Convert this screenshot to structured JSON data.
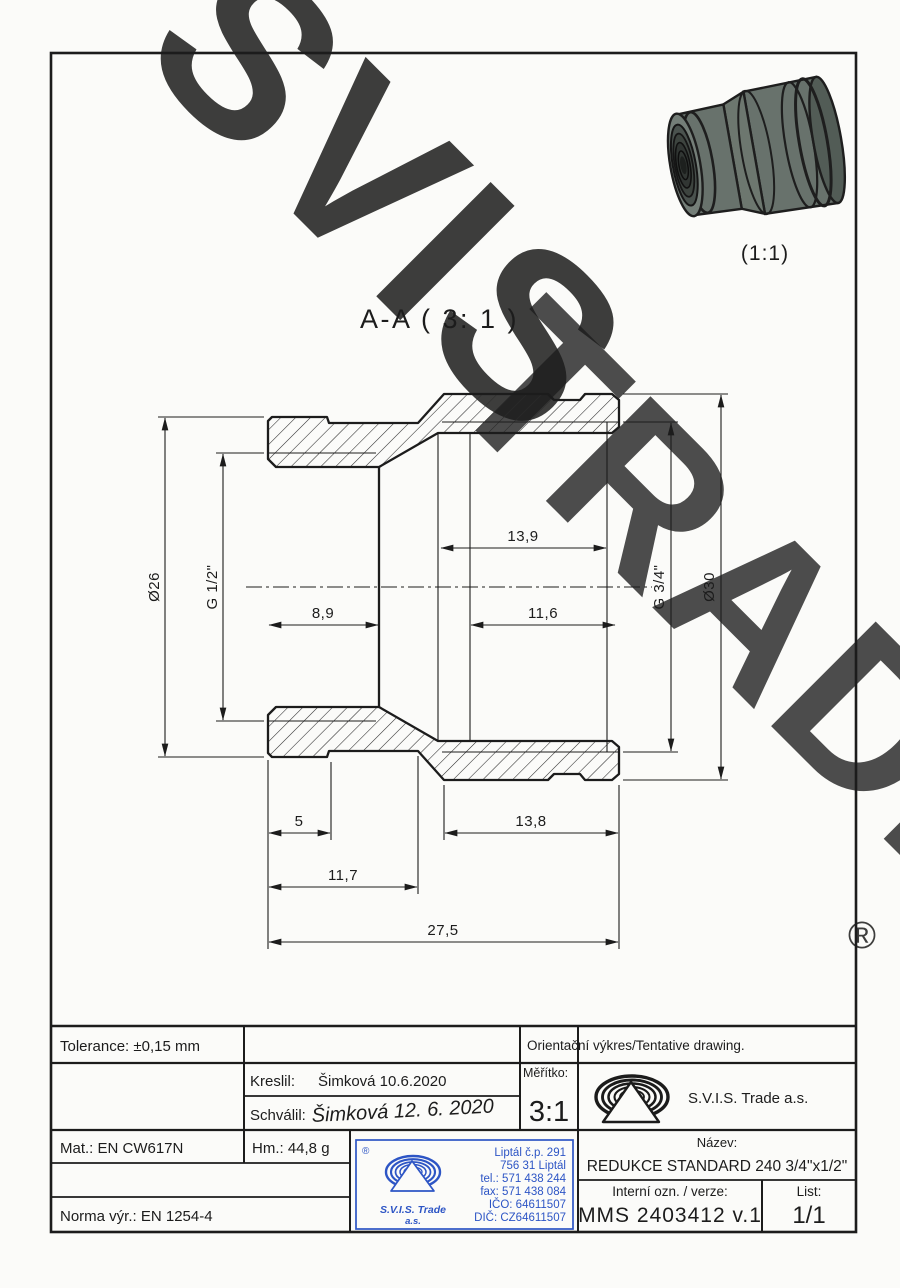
{
  "page": {
    "ink": "#1c1c1c",
    "blue": "#2d55c5",
    "watermark_gray": "#d8d8d8",
    "watermark_gold": "#f6d795"
  },
  "watermark": {
    "part1": "SVIS",
    "part2": "TRADE",
    "registered": "®"
  },
  "view3d": {
    "scale_label": "(1:1)"
  },
  "section": {
    "title": "A-A ( 3: 1 )",
    "dims": {
      "dia26": "Ø26",
      "g12": "G 1/2\"",
      "d89": "8,9",
      "d139": "13,9",
      "d116": "11,6",
      "g34": "G 3/4\"",
      "dia30": "Ø30",
      "d5": "5",
      "d117": "11,7",
      "d138": "13,8",
      "d275": "27,5"
    }
  },
  "title_block": {
    "tolerance": "Tolerance: ±0,15 mm",
    "orientation_note": "Orientační výkres/Tentative drawing.",
    "kreslil_label": "Kreslil:",
    "kreslil_value": "Šimková 10.6.2020",
    "schvalil_label": "Schválil:",
    "schvalil_signature": "Šimková 12. 6. 2020",
    "meritko_label": "Měřítko:",
    "meritko_value": "3:1",
    "company": "S.V.I.S. Trade a.s.",
    "mat": "Mat.: EN CW617N",
    "hm": "Hm.: 44,8 g",
    "norma": "Norma výr.: EN 1254-4",
    "nazev_label": "Název:",
    "nazev_value": "REDUKCE STANDARD 240 3/4\"x1/2\"",
    "interni_label": "Interní ozn. / verze:",
    "interni_value": "MMS 2403412 v.1",
    "list_label": "List:",
    "list_value": "1/1"
  },
  "stamp": {
    "registered": "®",
    "line1": "Liptál č.p. 291",
    "line2": "756 31 Liptál",
    "line3": "tel.: 571 438 244",
    "line4": "fax: 571 438 084",
    "line5": "IČO: 64611507",
    "line6": "DIČ: CZ64611507",
    "company1": "S.V.I.S. Trade",
    "company2": "a.s."
  }
}
